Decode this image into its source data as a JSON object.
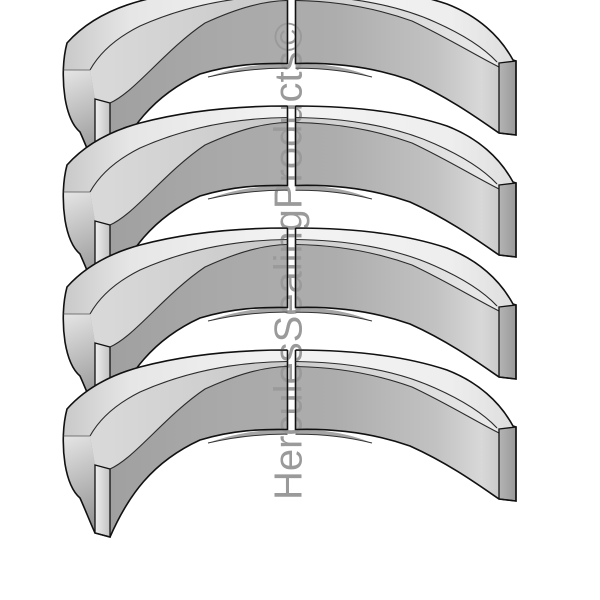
{
  "image": {
    "description": "Product illustration of four identical split seal rings stacked vertically",
    "background_color": "#ffffff"
  },
  "watermark": {
    "text": "HerculesSealingProducts©",
    "color": "#9a9a9a"
  },
  "scene": {
    "ring_count": 4,
    "ring_fill_color": "#ababab",
    "outline_color": "#111111"
  }
}
